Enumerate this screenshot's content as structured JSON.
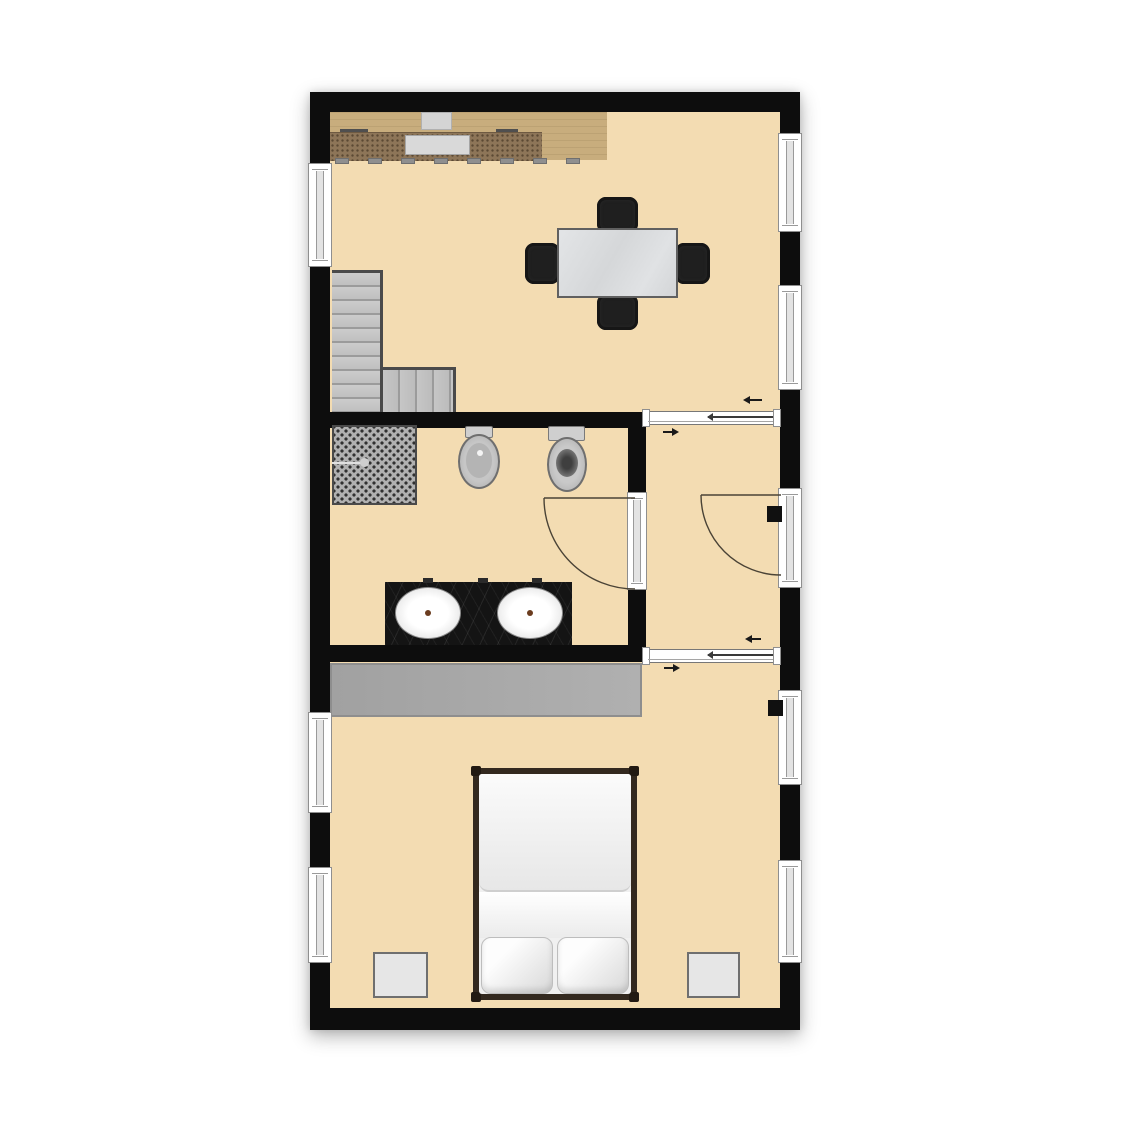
{
  "image_type": "top-down architectural floor plan, no text labels",
  "colors": {
    "canvas_background": "#ffffff",
    "walls": "#0d0d0d",
    "floor": "#f3dcb2",
    "kitchen_wood": "#c8ad7d",
    "kitchen_counter_dark": "#8d7558",
    "stairs_gray": "#c4c4c4",
    "wardrobe_gray": "#ababab",
    "table_marble": "#dcdee0",
    "chair_black": "#1f1f1f",
    "vanity_black_marble": "#141414",
    "fixture_gray": "#c6c6c6",
    "bed_frame_brown": "#33291f",
    "bedding_white": "#f0f0f0",
    "window_frame_gray": "#8f8f8f",
    "door_arc_line": "#4a4336",
    "arrow_black": "#1a1a1a"
  },
  "rooms": [
    {
      "id": "living-kitchen",
      "position": "top",
      "contents": [
        "kitchen counter with sink and cooktop",
        "dining table",
        "4 chairs",
        "L-shaped staircase"
      ]
    },
    {
      "id": "bathroom",
      "position": "middle-left",
      "contents": [
        "mosaic shower",
        "bidet",
        "toilet",
        "double-sink black vanity"
      ]
    },
    {
      "id": "hallway",
      "position": "middle-right",
      "contents": []
    },
    {
      "id": "bedroom",
      "position": "bottom",
      "contents": [
        "wardrobe",
        "double bed with 2 pillows",
        "left nightstand",
        "right nightstand"
      ]
    }
  ],
  "openings": {
    "windows_left_wall": 3,
    "windows_right_wall": 4,
    "hinged_doors": [
      "bathroom door with quarter-circle swing",
      "entry door on right wall with quarter-circle swing"
    ],
    "sliding_doors": [
      "hallway top sliding door with direction arrows",
      "hallway bottom sliding door with direction arrows"
    ],
    "door_handles_black_squares": 2
  }
}
